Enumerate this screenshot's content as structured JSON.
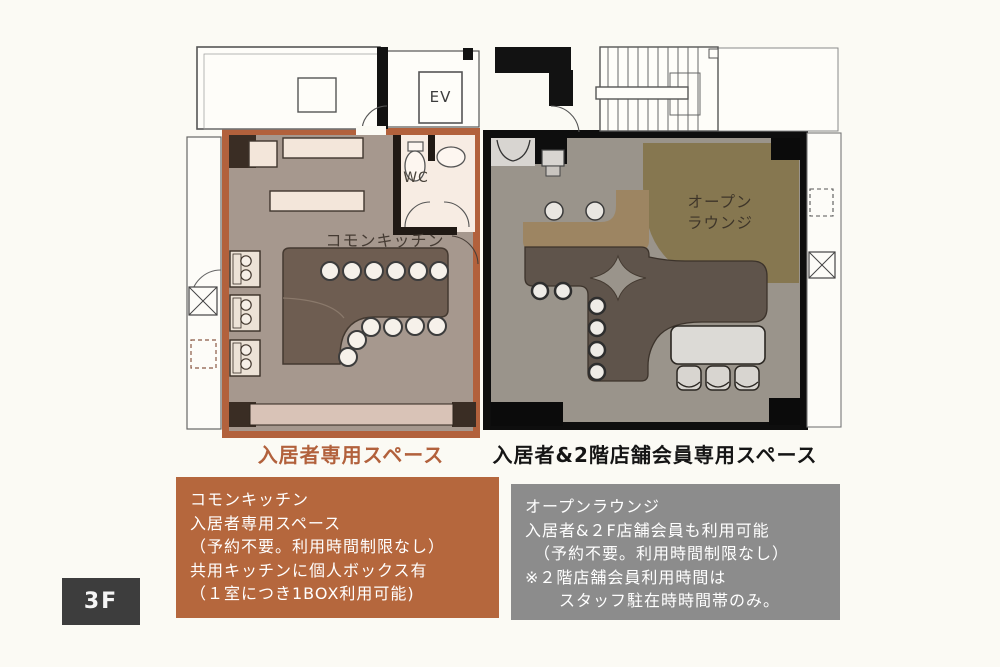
{
  "floor_badge": "3F",
  "plan": {
    "ev": "EV",
    "wc": "WC",
    "kitchen_label": "コモンキッチン",
    "lounge_label_1": "オープン",
    "lounge_label_2": "ラウンジ"
  },
  "captions": {
    "kitchen": "入居者専用スペース",
    "lounge": "入居者&2階店舗会員専用スペース"
  },
  "kitchen_info": {
    "lines": [
      "コモンキッチン",
      "入居者専用スペース",
      "（予約不要。利用時間制限なし）",
      "共用キッチンに個人ボックス有",
      "（１室につき1BOX利用可能)"
    ]
  },
  "lounge_info": {
    "lines": [
      "オープンラウンジ",
      "入居者&２F店舗会員も利用可能",
      "　（予約不要。利用時間制限なし）",
      "※２階店舗会員利用時間は",
      "　　スタッフ駐在時時間帯のみ。"
    ]
  },
  "colors": {
    "accent_orange": "#b2613c",
    "info_box_orange": "#b5673d",
    "info_box_gray": "#8c8c8c",
    "floor_badge_dark": "#3d3d3d",
    "kitchen_floor": "#a6988e",
    "kitchen_counter": "#6e5d51",
    "lounge_floor": "#9a948b",
    "lounge_counter": "#5f544b",
    "lounge_olive": "#867750",
    "lounge_tan": "#9d8562",
    "wall_black": "#0e0e0e"
  }
}
